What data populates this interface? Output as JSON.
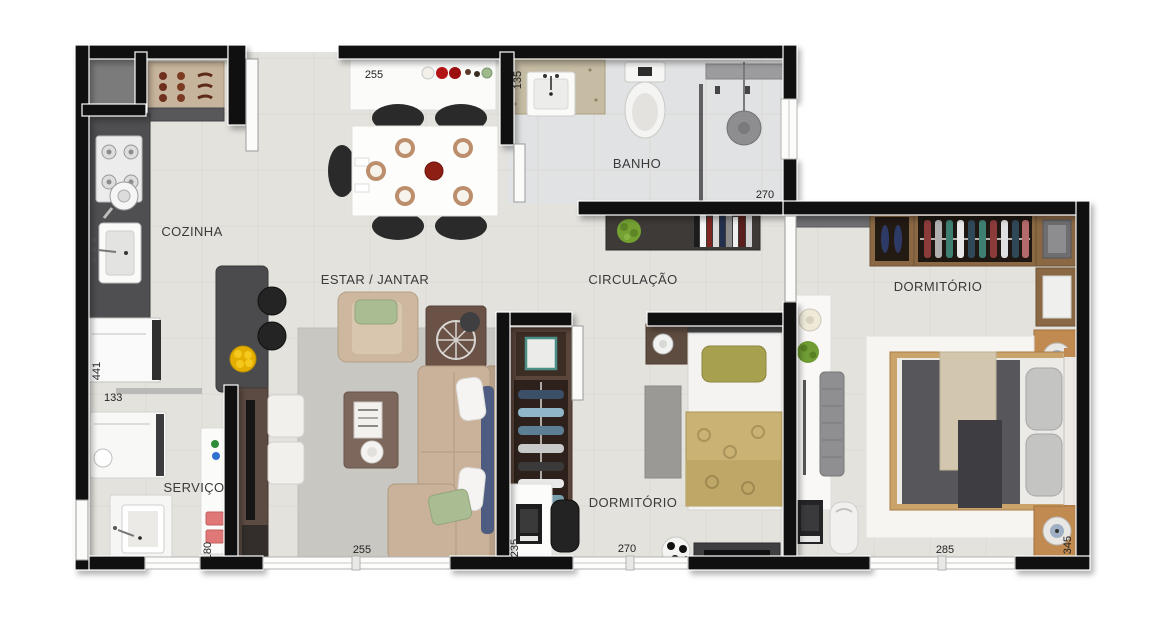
{
  "plan": {
    "type": "apartment-floor-plan",
    "rooms": {
      "cozinha": "COZINHA",
      "estar_jantar": "ESTAR / JANTAR",
      "banho": "BANHO",
      "circulacao": "CIRCULAÇÃO",
      "dormitorio_1": "DORMITÓRIO",
      "dormitorio_2": "DORMITÓRIO",
      "servico": "SERVIÇO"
    },
    "dims": {
      "jantar_width": "255",
      "banho_depth": "135",
      "banho_width": "270",
      "cozinha_height": "441",
      "cozinha_width": "133",
      "servico_width": "180",
      "estar_width": "255",
      "dorm1_depth": "235",
      "dorm1_width": "270",
      "dorm2_width": "285",
      "dorm2_depth": "345"
    },
    "colors": {
      "wall": "#101010",
      "floor": "#e4e2dd",
      "bath_floor": "#e0e2e3",
      "granite": "#4e4e50",
      "wood_dark": "#4a342c",
      "wood_mid": "#6b5246",
      "wood_light": "#c08a50",
      "sofa_beige": "#c9b299",
      "cushion_green": "#a9bc92",
      "pillow_olive": "#a7a04f",
      "blanket_gold": "#c9b273",
      "rug_gray": "#c9c7c2",
      "accent_red": "#b41313",
      "fruit_yellow": "#e3ae00"
    }
  }
}
